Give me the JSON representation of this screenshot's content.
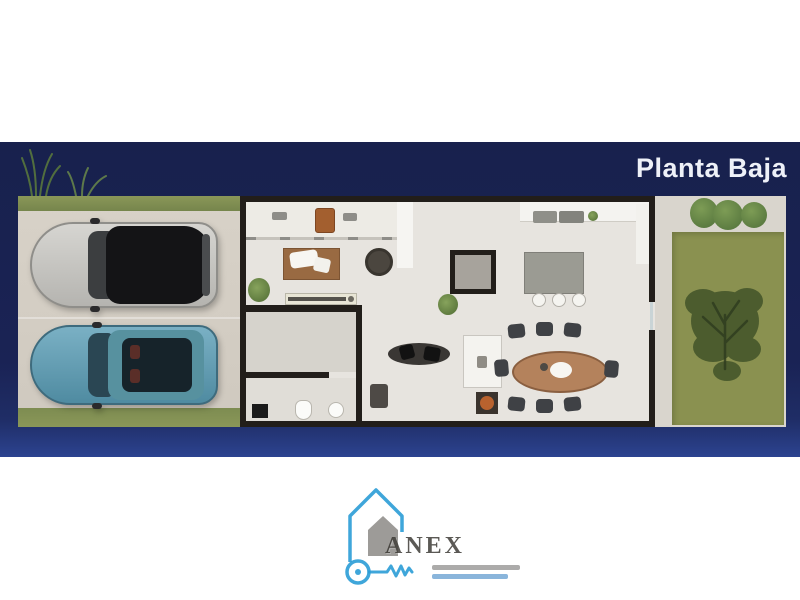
{
  "banner": {
    "title": "Planta Baja"
  },
  "watermark": {
    "brand": "ANEX",
    "icon": "house-key-icon"
  },
  "colors": {
    "page_background": "#ffffff",
    "banner_navy": "#1a2355",
    "banner_navy_light": "#2c4390",
    "title_text": "#eef1f8",
    "wall": "#221e1a",
    "interior_floor": "#e7e4df",
    "driveway_concrete": "#d5cfc5",
    "grass_strip": "#7f8d52",
    "garden_lawn": "#8a9150",
    "garden_path": "#d9d5cd",
    "watermark_accent_blue": "#2a9cd6",
    "silver_car_body": "#c9c8c4",
    "silver_car_roof": "#141416",
    "teal_car_body": "#64a3ba",
    "teal_car_glass": "#16232a",
    "living_rug": "#996a42",
    "dining_table": "#b4825c",
    "dining_chairs": "#3f4145",
    "kitchen_island": "#9b9b93",
    "tree_foliage": "#46572b"
  }
}
